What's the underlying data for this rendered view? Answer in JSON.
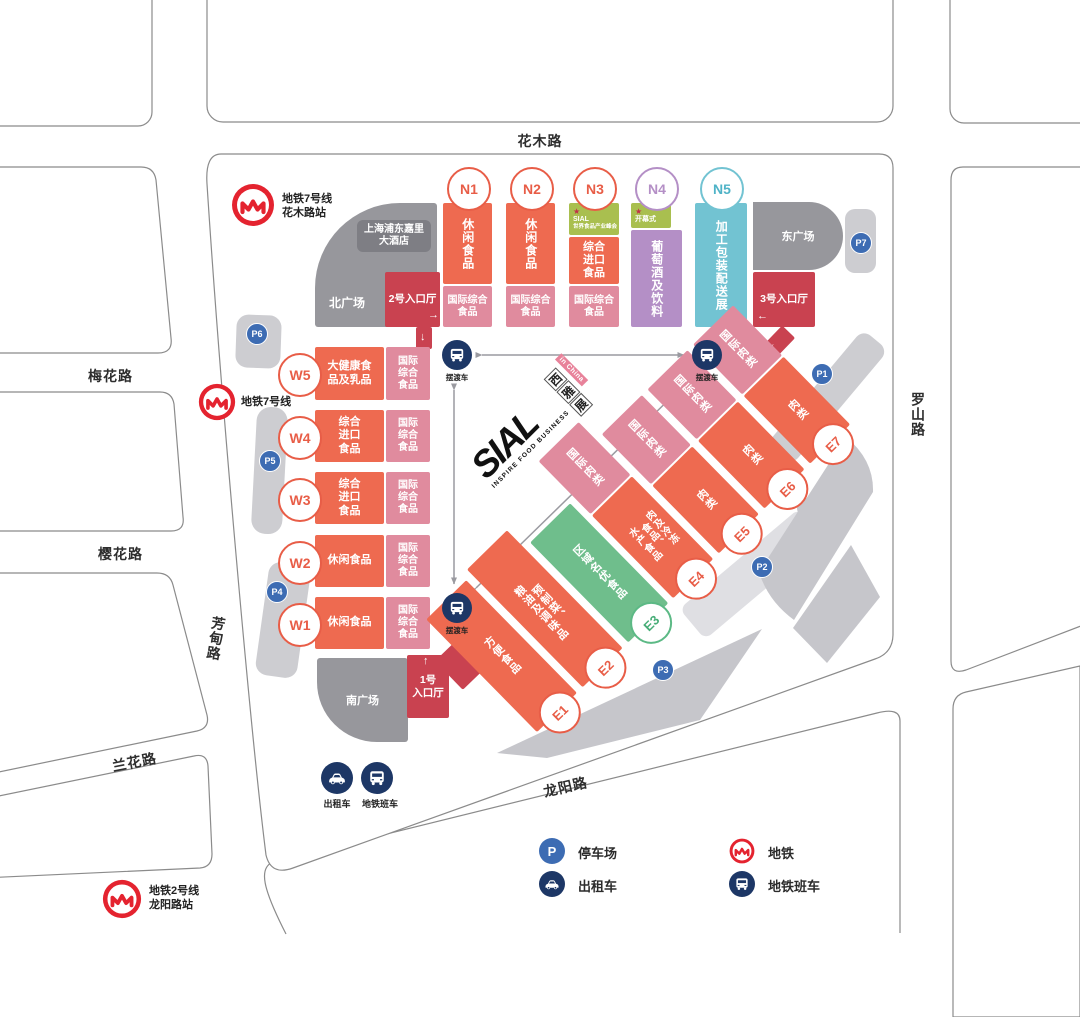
{
  "colors": {
    "orange": "#ee6a50",
    "pink": "#e08b9e",
    "dark_red": "#c94250",
    "lime_header": "#a9bf4f",
    "green": "#6fbe8c",
    "purple": "#b48fc6",
    "teal": "#72c3d2",
    "plaza_gray": "#97979c",
    "strip_gray": "#cdcdd1",
    "parking_blue": "#3d6cb3",
    "navy": "#1d3766",
    "metro_red": "#e4232f"
  },
  "icons": {
    "star": "★",
    "arrow_up": "↑",
    "arrow_down": "↓",
    "arrow_left": "←",
    "arrow_right": "→"
  },
  "roads": {
    "huamu": "花木路",
    "meihua": "梅花路",
    "yinghua": "樱花路",
    "fangdian": "芳甸路",
    "lanhua": "兰花路",
    "longyang": "龙阳路",
    "luoshan": "罗山路"
  },
  "metro": {
    "m7_huamu": "地铁7号线\n花木路站",
    "m7": "地铁7号线",
    "m2_longyang": "地铁2号线\n龙阳路站"
  },
  "plazas": {
    "north": "北广场",
    "south": "南广场",
    "east": "东广场",
    "hotel": "上海浦东嘉里\n大酒店"
  },
  "entrances": {
    "no1": "1号\n入口厅",
    "no2": "2号入口厅",
    "no3": "3号入口厅"
  },
  "parking": {
    "p1": "P1",
    "p2": "P2",
    "p3": "P3",
    "p4": "P4",
    "p5": "P5",
    "p6": "P6",
    "p7": "P7"
  },
  "shuttle_label": "摆渡车",
  "ground_transport": {
    "taxi": "出租车",
    "metro_bus": "地铁班车"
  },
  "legend": {
    "parking": "停车场",
    "taxi": "出租车",
    "metro": "地铁",
    "metro_bus": "地铁班车"
  },
  "logo": {
    "name": "SIAL",
    "cn1": "西",
    "cn2": "雅",
    "cn3": "展",
    "tag": "in China",
    "tagline": "INSPIRE FOOD BUSINESS"
  },
  "halls": {
    "north": [
      {
        "id": "N1",
        "main": "休闲食品",
        "sub": "国际综合\n食品"
      },
      {
        "id": "N2",
        "main": "休闲食品",
        "sub": "国际综合\n食品"
      },
      {
        "id": "N3",
        "header_top": "SIAL",
        "header_sub": "世界食品产业峰会",
        "main": "综合\n进口\n食品",
        "sub": "国际综合\n食品"
      },
      {
        "id": "N4",
        "header": "开幕式",
        "main": "葡萄酒及饮料"
      },
      {
        "id": "N5",
        "main": "加工包装配送展"
      }
    ],
    "west": [
      {
        "id": "W5",
        "main": "大健康食\n品及乳品",
        "sub": "国际\n综合\n食品"
      },
      {
        "id": "W4",
        "main": "综合\n进口\n食品",
        "sub": "国际\n综合\n食品"
      },
      {
        "id": "W3",
        "main": "综合\n进口\n食品",
        "sub": "国际\n综合\n食品"
      },
      {
        "id": "W2",
        "main": "休闲食品",
        "sub": "国际\n综合\n食品"
      },
      {
        "id": "W1",
        "main": "休闲食品",
        "sub": "国际\n综合\n食品"
      }
    ],
    "east": [
      {
        "id": "E1",
        "main": "方便食品"
      },
      {
        "id": "E2",
        "main": "预制菜、\n粮油及调味品"
      },
      {
        "id": "E3",
        "main": "区域名优食品"
      },
      {
        "id": "E4",
        "main": "肉及冷冻\n食品、\n水产食品",
        "sub": "国际肉类"
      },
      {
        "id": "E5",
        "main": "肉类",
        "sub": "国际肉类"
      },
      {
        "id": "E6",
        "main": "肉类",
        "sub": "国际肉类"
      },
      {
        "id": "E7",
        "main": "肉类",
        "sub": "国际肉类"
      }
    ]
  }
}
